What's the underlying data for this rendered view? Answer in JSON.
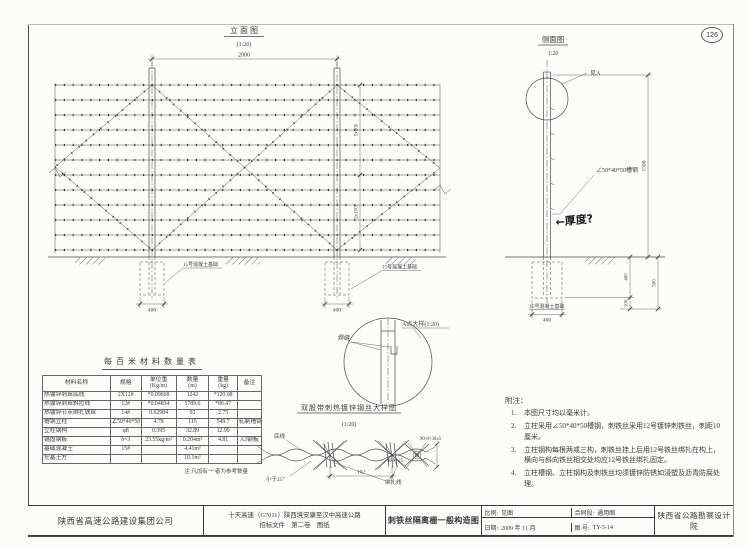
{
  "page": {
    "sheet_number": "126"
  },
  "elevation": {
    "title": "立 面 图",
    "scale": "(1:20)",
    "dim_span": "2000",
    "dim_upper": "5x200",
    "dim_lower": "2x150",
    "foundation_label_left": "15号混凝土基础",
    "foundation_label_right": "15号混凝土基础",
    "dim_foundation_left": "400",
    "dim_foundation_right": "400"
  },
  "side_view": {
    "title": "侧面图",
    "scale": "1:20",
    "detail_ref": "见A",
    "post_label": "∠50*40*50槽钢",
    "handwritten_note": "←厚度?",
    "dim_height": "1500",
    "foundation_label": "15号混凝土基础",
    "dim_foundation_width": "400",
    "dim_embed": "400",
    "dim_bed": "100",
    "dim_total": "500"
  },
  "detail_a": {
    "title": "A点大样(1:20)",
    "weld_label": "焊缝"
  },
  "wire_detail": {
    "title": "双股带刺热镀锌钢丝大样图",
    "scale": "(1:20)",
    "label_main_wire": "底线",
    "label_angle": "小于25°",
    "dim_barb_spacing": "102",
    "label_binding": "绑扎线",
    "label_barb_top": "90-8×30±5",
    "label_barb_left": "90-8×25"
  },
  "material_table": {
    "title": "每百米材料数量表",
    "headers": [
      {
        "label": "材料名称",
        "unit": ""
      },
      {
        "label": "规格",
        "unit": ""
      },
      {
        "label": "单位重",
        "unit": "(Kg/m)"
      },
      {
        "label": "数量",
        "unit": "(m)"
      },
      {
        "label": "重量",
        "unit": "(kg)"
      },
      {
        "label": "备注",
        "unit": ""
      }
    ],
    "rows": [
      {
        "name": "热镀锌刺丝底线",
        "spec": "2X12#",
        "unit_weight": "*0.09668",
        "quantity": "1242",
        "weight": "*120.08",
        "remark": ""
      },
      {
        "name": "热镀锌刺丝斜拉线",
        "spec": "12#",
        "unit_weight": "*0.04834",
        "quantity": "1789.6",
        "weight": "*86.47",
        "remark": ""
      },
      {
        "name": "热镀锌节点绑扎铁丝",
        "spec": "14#",
        "unit_weight": "0.02984",
        "quantity": "92",
        "weight": "2.75",
        "remark": ""
      },
      {
        "name": "槽钢立柱",
        "spec": "∠50*40*50",
        "unit_weight": "4.78",
        "quantity": "115",
        "weight": "549.7",
        "remark": "轧制槽钢"
      },
      {
        "name": "立柱钢构",
        "spec": "φ8",
        "unit_weight": "0.395",
        "quantity": "32.89",
        "weight": "12.99",
        "remark": ""
      },
      {
        "name": "锚固钢板",
        "spec": "δ=3",
        "unit_weight": "23.55kg/m²",
        "quantity": "0.204m²",
        "weight": "4.81",
        "remark": "A3钢板"
      },
      {
        "name": "基础混凝土",
        "spec": "15#",
        "unit_weight": "",
        "quantity": "4.41m³",
        "weight": "",
        "remark": ""
      },
      {
        "name": "挖基土方",
        "spec": "",
        "unit_weight": "",
        "quantity": "10.1m³",
        "weight": "",
        "remark": ""
      }
    ],
    "footnote": "注:凡加有\"*\"者为参考数量"
  },
  "notes": {
    "heading": "附注：",
    "items": [
      "本图尺寸均以毫米计。",
      "立柱采用∠50*40*50槽钢，刺铁丝采用12号镀锌刺铁丝，刺距10厘米。",
      "立柱钢构每根两或三构，刺铁丝挂上后用12号铁丝绑扎在构上，横向与斜向铁丝相交处均应12号铁丝绑扎固定。",
      "立柱槽钢、立柱钢构及刺铁丝均须镀锌防锈如浸塑及沥青防腐处理。"
    ]
  },
  "title_block": {
    "company": "陕西省高速公路建设集团公司",
    "project_line1": "十天高速（G7011）陕西境安康至汉中高速公路",
    "project_line2": "招标文件　第二卷　图纸",
    "drawing_title": "刺铁丝隔离栅一般构造图",
    "scale_label": "比例:",
    "scale_value": "见图",
    "section_label": "合同段:",
    "section_value": "通用图",
    "date_label": "日期:",
    "date_value": "2009 年 11 月",
    "number_label": "图 号:",
    "number_value": "TY-5-14",
    "institute": "陕西省公路勘察设计院"
  }
}
